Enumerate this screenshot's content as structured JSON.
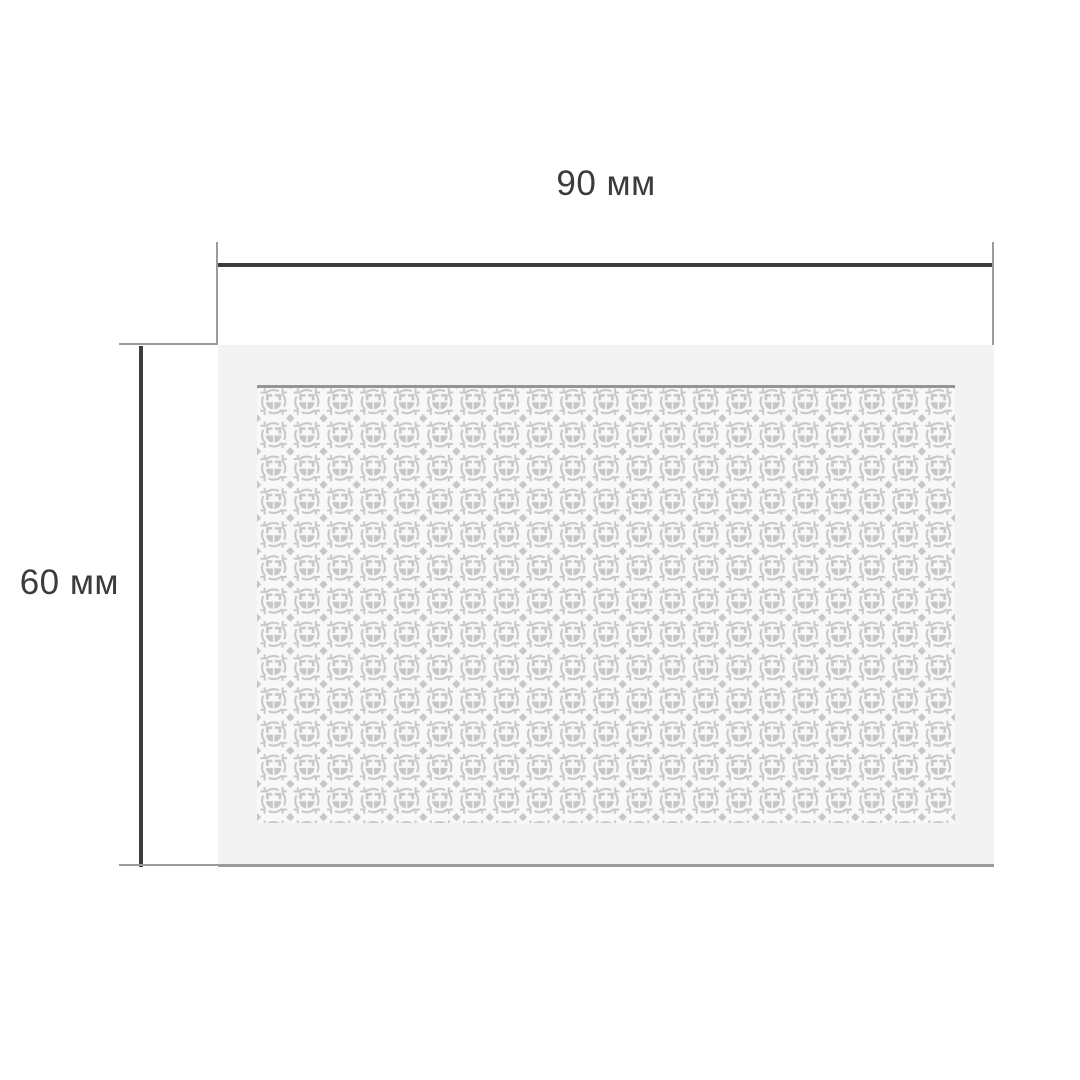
{
  "dimensions": {
    "width_label": "90 мм",
    "height_label": "60 мм"
  },
  "diagram": {
    "subject": "perforated-screen-panel"
  },
  "colors": {
    "dimension_line": "#3d3d3d",
    "extension_line": "#9b9b9b",
    "panel_face": "#f3f3f3",
    "pattern_background": "#f8f8f8",
    "pattern_motif": "#c7c7c7",
    "pattern_top_shadow": "#959595",
    "label_text": "#3b3b3b",
    "page_background": "#ffffff"
  }
}
